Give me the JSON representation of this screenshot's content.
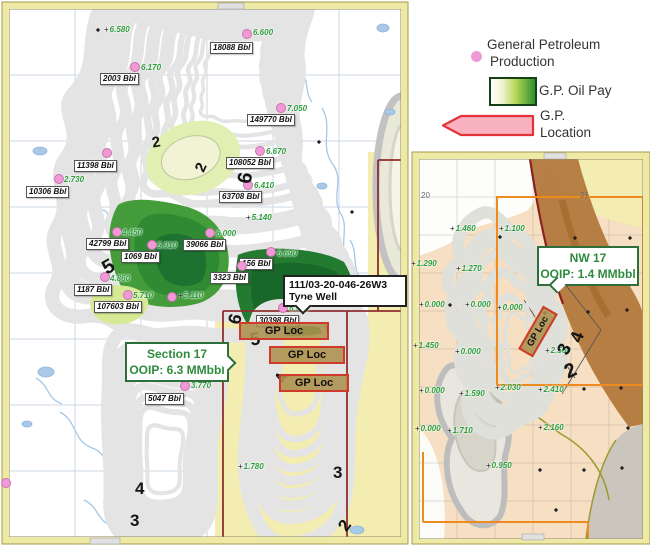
{
  "legend": {
    "production_line1": "General Petroleum",
    "production_line2": "Production",
    "oil_pay_label": "G.P. Oil Pay",
    "location_line1": "G.P.",
    "location_line2": "Location"
  },
  "colors": {
    "frame_yellow": "#efe9a6",
    "pay_dark_green": "#115a26",
    "pay_light_cream": "#f0efcf",
    "yellow_zone": "#f3edb2",
    "section_line_red": "#8f2f2f",
    "gp_loc_fill": "#ac8f4d",
    "gp_loc_border": "#cf3a2a",
    "production_dot_pink": "#ef9ad6",
    "value_text_green": "#2f9e3f",
    "callout_green": "#2e8b3e",
    "orange_grid": "#ef8a1e",
    "brown_band": "#b17539",
    "inset_peach": "#f6dfc2",
    "location_arrow_fill": "#f8b2bf",
    "location_arrow_border": "#e23338"
  },
  "main_map": {
    "wells": [
      {
        "bbl": "18088 Bbl",
        "value": "6.600",
        "dot": [
          247,
          34
        ],
        "label": [
          210,
          42
        ],
        "value_pos": [
          253,
          28
        ]
      },
      {
        "bbl": "2003 Bbl",
        "value": "6.170",
        "dot": [
          135,
          67
        ],
        "label": [
          100,
          73
        ],
        "value_pos": [
          141,
          63
        ]
      },
      {
        "bbl": "149770 Bbl",
        "value": "7.050",
        "dot": [
          281,
          108
        ],
        "label": [
          247,
          114
        ],
        "value_pos": [
          287,
          104
        ]
      },
      {
        "bbl": "11398 Bbl",
        "value": "",
        "dot": [
          107,
          153
        ],
        "label": [
          74,
          160
        ],
        "value_pos": [
          113,
          150
        ]
      },
      {
        "bbl": "108052 Bbl",
        "value": "6.670",
        "dot": [
          260,
          151
        ],
        "label": [
          226,
          157
        ],
        "value_pos": [
          266,
          147
        ]
      },
      {
        "bbl": "10306 Bbl",
        "value": "2.730",
        "dot": [
          59,
          179
        ],
        "label": [
          26,
          186
        ],
        "value_pos": [
          64,
          175
        ]
      },
      {
        "bbl": "63708 Bbl",
        "value": "6.410",
        "dot": [
          248,
          185
        ],
        "label": [
          219,
          191
        ],
        "value_pos": [
          254,
          181
        ]
      },
      {
        "bbl": "42799 Bbl",
        "value": "4.450",
        "dot": [
          117,
          232
        ],
        "label": [
          86,
          238
        ],
        "value_pos": [
          122,
          228
        ]
      },
      {
        "bbl": "39066 Bbl",
        "value": "6.000",
        "dot": [
          210,
          233
        ],
        "label": [
          183,
          239
        ],
        "value_pos": [
          216,
          229
        ]
      },
      {
        "bbl": "1069 Bbl",
        "value": "5.910",
        "dot": [
          152,
          245
        ],
        "label": [
          121,
          251
        ],
        "value_pos": [
          157,
          241
        ]
      },
      {
        "bbl": "156 Bbl",
        "value": "6.690",
        "dot": [
          271,
          252
        ],
        "label": [
          239,
          258
        ],
        "value_pos": [
          277,
          249
        ]
      },
      {
        "bbl": "3323 Bbl",
        "value": "",
        "dot": [
          242,
          266
        ],
        "label": [
          210,
          272
        ],
        "value_pos": [
          248,
          263
        ]
      },
      {
        "bbl": "1187 Bbl",
        "value": "4.860",
        "dot": [
          105,
          277
        ],
        "label": [
          74,
          284
        ],
        "value_pos": [
          110,
          274
        ]
      },
      {
        "bbl": "107603 Bbl",
        "value": "5.710",
        "dot": [
          128,
          295
        ],
        "label": [
          94,
          301
        ],
        "value_pos": [
          133,
          291
        ]
      },
      {
        "bbl": "30398 Bbl",
        "value": "6.990",
        "dot": [
          283,
          308
        ],
        "label": [
          256,
          315
        ],
        "value_pos": [
          289,
          304
        ]
      },
      {
        "bbl": "5047 Bbl",
        "value": "3.770",
        "dot": [
          185,
          386
        ],
        "label": [
          145,
          393
        ],
        "value_pos": [
          191,
          381
        ]
      }
    ],
    "extra_dots": [
      [
        172,
        297
      ],
      [
        6,
        483
      ]
    ],
    "spot_values": [
      {
        "value": "6.580",
        "pos": [
          104,
          25
        ]
      },
      {
        "value": "5.140",
        "pos": [
          246,
          213
        ]
      },
      {
        "value": "5.110",
        "pos": [
          178,
          291
        ]
      },
      {
        "value": "1.780",
        "pos": [
          238,
          462
        ]
      }
    ],
    "markers": [
      [
        98,
        30
      ],
      [
        319,
        142
      ],
      [
        352,
        212
      ]
    ],
    "contour_labels": [
      {
        "t": "2",
        "x": 152,
        "y": 135,
        "rot": -10,
        "size": 15
      },
      {
        "t": "2",
        "x": 197,
        "y": 160,
        "rot": -65,
        "size": 15
      },
      {
        "t": "6",
        "x": 240,
        "y": 168,
        "rot": -80,
        "size": 20
      },
      {
        "t": "5",
        "x": 103,
        "y": 257,
        "rot": -30,
        "size": 20
      },
      {
        "t": "6",
        "x": 230,
        "y": 310,
        "rot": -75,
        "size": 18
      },
      {
        "t": "5",
        "x": 250,
        "y": 330,
        "rot": -10,
        "size": 18
      },
      {
        "t": "4",
        "x": 278,
        "y": 370,
        "rot": -75,
        "size": 16
      },
      {
        "t": "4",
        "x": 135,
        "y": 480,
        "rot": 0,
        "size": 17
      },
      {
        "t": "3",
        "x": 130,
        "y": 512,
        "rot": 0,
        "size": 17
      },
      {
        "t": "3",
        "x": 333,
        "y": 464,
        "rot": 0,
        "size": 17
      },
      {
        "t": "2",
        "x": 340,
        "y": 517,
        "rot": -55,
        "size": 17
      }
    ],
    "gp_loc_label": "GP Loc",
    "gp_loc_boxes": [
      {
        "x": 239,
        "y": 322,
        "w": 86
      },
      {
        "x": 269,
        "y": 346,
        "w": 72
      },
      {
        "x": 279,
        "y": 374,
        "w": 66
      }
    ],
    "callouts": {
      "type_well": {
        "line1": "111/03-20-046-26W3",
        "line2": "Type Well"
      },
      "section17": {
        "line1": "Section 17",
        "line2": "OOIP: 6.3 MMbbl"
      }
    }
  },
  "inset_map": {
    "grid_labels": [
      {
        "t": "20",
        "x": 421,
        "y": 191
      },
      {
        "t": "21",
        "x": 580,
        "y": 191
      }
    ],
    "spot_values": [
      {
        "value": "1.460",
        "pos": [
          450,
          224
        ]
      },
      {
        "value": "1.100",
        "pos": [
          499,
          224
        ]
      },
      {
        "value": "1.290",
        "pos": [
          411,
          259
        ]
      },
      {
        "value": "1.270",
        "pos": [
          456,
          264
        ]
      },
      {
        "value": "0.000",
        "pos": [
          419,
          300
        ]
      },
      {
        "value": "0.000",
        "pos": [
          465,
          300
        ]
      },
      {
        "value": "0.000",
        "pos": [
          497,
          303
        ]
      },
      {
        "value": "1.450",
        "pos": [
          413,
          341
        ]
      },
      {
        "value": "0.000",
        "pos": [
          455,
          347
        ]
      },
      {
        "value": "2.560",
        "pos": [
          545,
          346
        ]
      },
      {
        "value": "0.000",
        "pos": [
          419,
          386
        ]
      },
      {
        "value": "1.590",
        "pos": [
          459,
          389
        ]
      },
      {
        "value": "2.030",
        "pos": [
          495,
          383
        ]
      },
      {
        "value": "2.410",
        "pos": [
          538,
          385
        ]
      },
      {
        "value": "0.000",
        "pos": [
          415,
          424
        ]
      },
      {
        "value": "1.710",
        "pos": [
          447,
          426
        ]
      },
      {
        "value": "2.160",
        "pos": [
          538,
          423
        ]
      },
      {
        "value": "0.950",
        "pos": [
          486,
          461
        ]
      }
    ],
    "markers": [
      [
        500,
        237
      ],
      [
        575,
        238
      ],
      [
        630,
        238
      ],
      [
        450,
        305
      ],
      [
        545,
        313
      ],
      [
        588,
        312
      ],
      [
        627,
        310
      ],
      [
        584,
        389
      ],
      [
        621,
        388
      ],
      [
        628,
        428
      ],
      [
        540,
        470
      ],
      [
        584,
        470
      ],
      [
        622,
        468
      ],
      [
        556,
        510
      ]
    ],
    "contour_labels": [
      {
        "t": "4",
        "x": 572,
        "y": 328,
        "rot": -70,
        "size": 18
      },
      {
        "t": "3",
        "x": 559,
        "y": 340,
        "rot": -65,
        "size": 18
      },
      {
        "t": "2",
        "x": 565,
        "y": 361,
        "rot": -25,
        "size": 20
      }
    ],
    "gp_loc_label": "GP Loc",
    "gp_loc_box": {
      "x": 513,
      "y": 323,
      "w": 46
    },
    "callouts": {
      "nw17": {
        "line1": "NW 17",
        "line2": "OOIP: 1.4 MMbbl"
      }
    }
  }
}
